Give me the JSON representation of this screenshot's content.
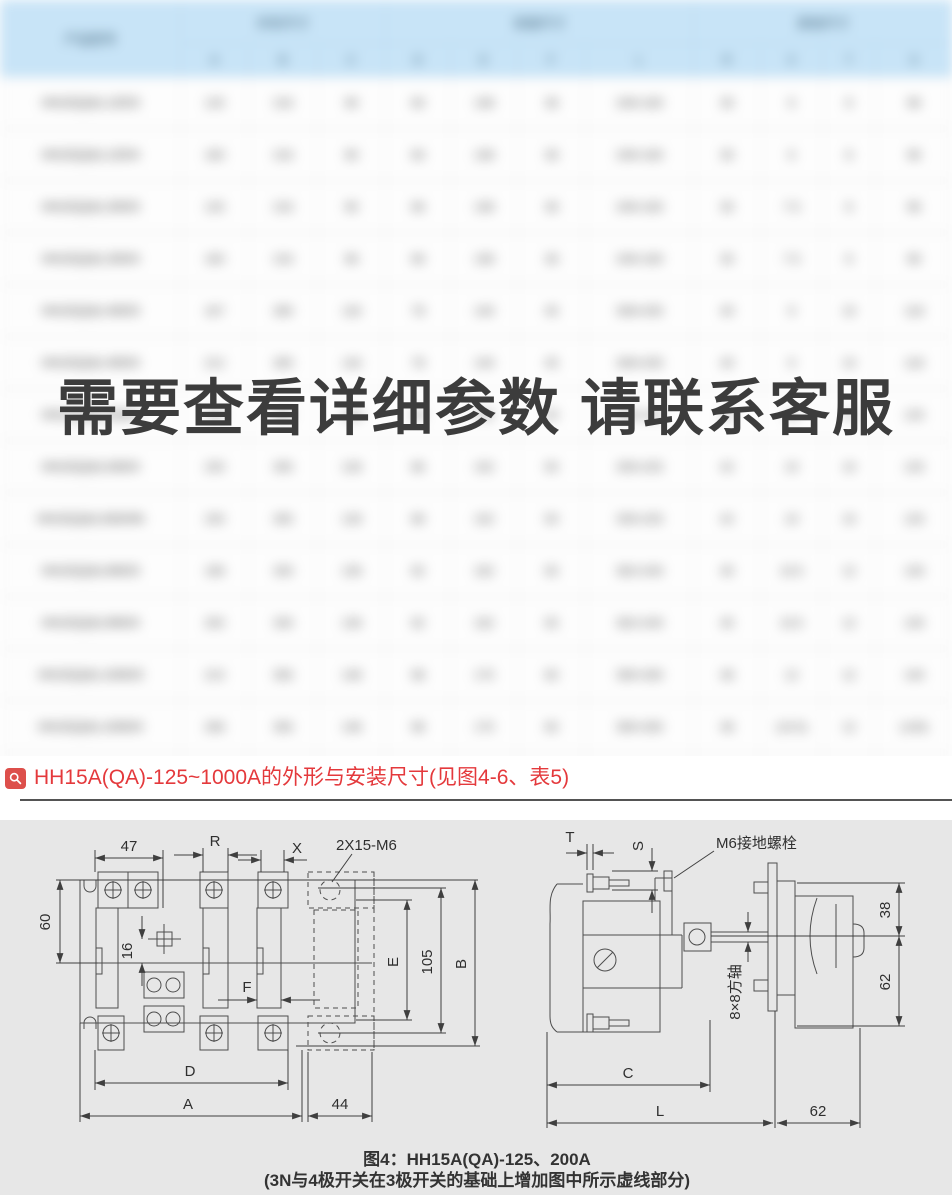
{
  "watermark": "需要查看详细参数 请联系客服",
  "blurred_table": {
    "blurred": true,
    "model_header": "产品型号",
    "groups": [
      {
        "label": "外形尺寸",
        "span": 3
      },
      {
        "label": "安装尺寸",
        "span": 4
      },
      {
        "label": "其他尺寸",
        "span": 4
      }
    ],
    "sub_headers": [
      "A",
      "B",
      "C",
      "D",
      "E",
      "F",
      "L",
      "R",
      "X",
      "T",
      "S"
    ],
    "rows": [
      [
        "HH15(QA)-125/3",
        "125",
        "216",
        "90",
        "60",
        "108",
        "36",
        "246×160",
        "35",
        "6",
        "8",
        "96"
      ],
      [
        "HH15(QA)-125/4",
        "160",
        "216",
        "90",
        "60",
        "108",
        "36",
        "246×160",
        "35",
        "6",
        "8",
        "96"
      ],
      [
        "HH15(QA)-200/3",
        "125",
        "216",
        "90",
        "66",
        "108",
        "36",
        "246×160",
        "35",
        "7.5",
        "8",
        "96"
      ],
      [
        "HH15(QA)-200/4",
        "160",
        "216",
        "96",
        "66",
        "108",
        "36",
        "246×160",
        "35",
        "7.5",
        "8",
        "96"
      ],
      [
        "HH15(QA)-400/3",
        "167",
        "280",
        "118",
        "78",
        "140",
        "45",
        "308×205",
        "40",
        "9",
        "10",
        "118"
      ],
      [
        "HH15(QA)-400/4",
        "212",
        "280",
        "118",
        "78",
        "140",
        "45",
        "308×205",
        "40",
        "9",
        "10",
        "118"
      ],
      [
        "HH15(QA)-630/3",
        "180",
        "305",
        "128",
        "86",
        "152",
        "50",
        "335×225",
        "42",
        "10",
        "10",
        "125"
      ],
      [
        "HH15(QA)-630/4",
        "230",
        "305",
        "128",
        "86",
        "152",
        "50",
        "335×225",
        "42",
        "10",
        "10",
        "125"
      ],
      [
        "HH15(QA)-630/4N",
        "230",
        "305",
        "128",
        "86",
        "152",
        "50",
        "335×225",
        "42",
        "10",
        "10",
        "125"
      ],
      [
        "HH15(QA)-800/3",
        "196",
        "330",
        "136",
        "92",
        "162",
        "55",
        "362×240",
        "45",
        "10.5",
        "12",
        "130"
      ],
      [
        "HH15(QA)-800/4",
        "250",
        "330",
        "136",
        "92",
        "162",
        "55",
        "362×240",
        "45",
        "10.5",
        "12",
        "130"
      ],
      [
        "HH15(QA)-1000/3",
        "210",
        "356",
        "148",
        "98",
        "175",
        "60",
        "390×260",
        "48",
        "12",
        "12",
        "140"
      ],
      [
        "HH15(QA)-1000/4",
        "268",
        "356",
        "148",
        "98",
        "175",
        "60",
        "390×260",
        "48",
        "(10.5)",
        "12",
        "(140)"
      ],
      [
        "HH15(QA)-1000/4N",
        "268",
        "356",
        "148",
        "98",
        "175",
        "60",
        "390×260",
        "48",
        "(10.5)",
        "12",
        "(140)"
      ]
    ]
  },
  "heading": {
    "text": "HH15A(QA)-125~1000A的外形与安装尺寸(见图4-6、表5)",
    "accent_color": "#e4393c"
  },
  "diagram": {
    "left": {
      "dim_47": "47",
      "dim_R": "R",
      "dim_X": "X",
      "bolt_label": "2X15-M6",
      "dim_60": "60",
      "dim_16": "16",
      "dim_E": "E",
      "dim_105": "105",
      "dim_B": "B",
      "dim_F": "F",
      "dim_D": "D",
      "dim_A": "A",
      "dim_44": "44"
    },
    "right": {
      "dim_T": "T",
      "dim_S": "S",
      "ground_label": "M6接地螺栓",
      "dim_38": "38",
      "dim_62": "62",
      "shaft_label": "8×8方轴",
      "dim_C": "C",
      "dim_L": "L",
      "dim_62b": "62"
    },
    "caption_line1": "图4：HH15A(QA)-125、200A",
    "caption_line2": "(3N与4极开关在3极开关的基础上增加图中所示虚线部分)"
  }
}
